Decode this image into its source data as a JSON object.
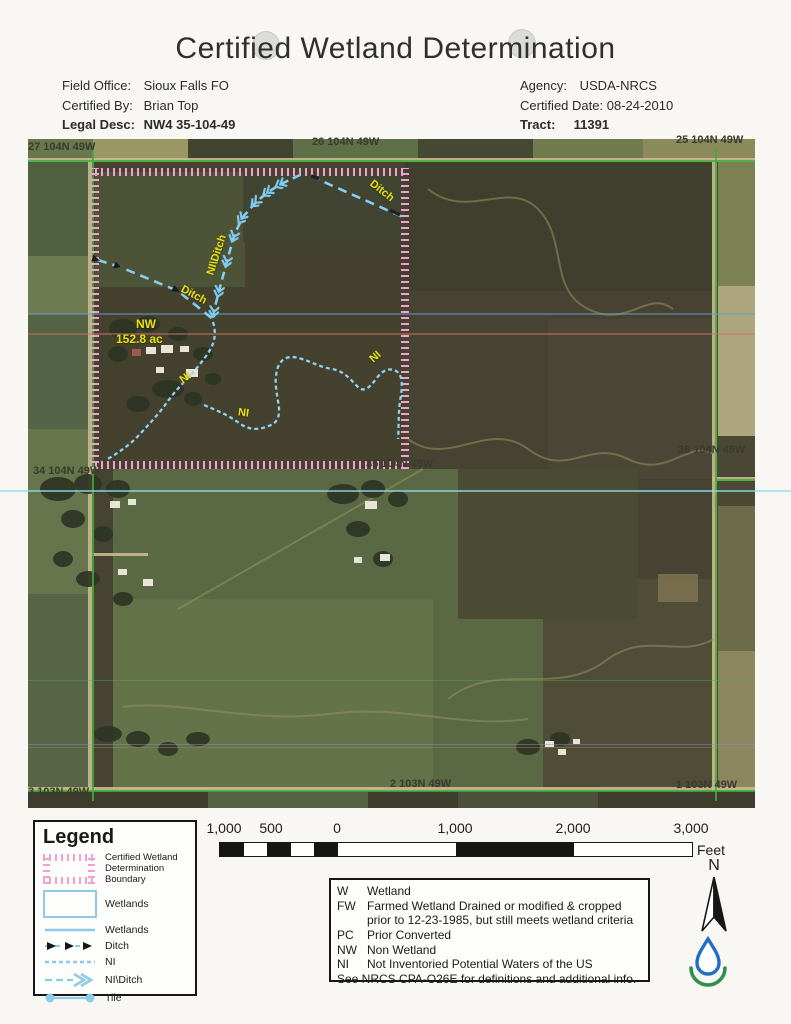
{
  "title": "Certified Wetland Determination",
  "header": {
    "field_office_label": "Field Office:",
    "field_office": "Sioux Falls FO",
    "certified_by_label": "Certified By:",
    "certified_by": "Brian Top",
    "legal_desc_label": "Legal Desc:",
    "legal_desc": "NW4 35-104-49",
    "agency_label": "Agency:",
    "agency": "USDA-NRCS",
    "certified_date_label": "Certified Date:",
    "certified_date": "08-24-2010",
    "tract_label": "Tract:",
    "tract": "11391"
  },
  "map": {
    "sections": [
      {
        "text": "27 104N 49W"
      },
      {
        "text": "26 104N 49W"
      },
      {
        "text": "25 104N 49W"
      },
      {
        "text": "34 104N 49W"
      },
      {
        "text": "35 104N 49W"
      },
      {
        "text": "36 104N 49W"
      },
      {
        "text": "3 103N 49W"
      },
      {
        "text": "2 103N 49W"
      },
      {
        "text": "1 103N 49W"
      }
    ],
    "labels": {
      "ditch_top": "Ditch",
      "ditch_west": "Ditch",
      "ni_ditch": "NI\\Ditch",
      "ni_west": "NI",
      "ni_mid": "NI",
      "ni_east": "NI",
      "area_code": "NW",
      "area_acres": "152.8 ac"
    },
    "colors": {
      "boundary_pink": "#f2a0d0",
      "hydro_blue": "#8ad0f4",
      "label_yellow": "#e6e112",
      "section_green": "#3fae3c"
    }
  },
  "legend": {
    "title": "Legend",
    "items": [
      {
        "label": "Certified Wetland Determination Boundary"
      },
      {
        "label": "Wetlands"
      },
      {
        "label": "Wetlands"
      },
      {
        "label": "Ditch"
      },
      {
        "label": "NI"
      },
      {
        "label": "NI\\Ditch"
      },
      {
        "label": "Tile"
      }
    ]
  },
  "scalebar": {
    "ticks": [
      "1,000",
      "500",
      "0",
      "1,000",
      "2,000",
      "3,000"
    ],
    "unit": "Feet"
  },
  "north": {
    "label": "N"
  },
  "definitions": {
    "rows": [
      {
        "code": "W",
        "text": "Wetland"
      },
      {
        "code": "FW",
        "text": "Farmed Wetland Drained or modified & cropped prior to 12-23-1985, but still meets wetland criteria"
      },
      {
        "code": "PC",
        "text": "Prior Converted"
      },
      {
        "code": "NW",
        "text": "Non Wetland"
      },
      {
        "code": "NI",
        "text": "Not Inventoried Potential Waters of the US"
      }
    ],
    "footnote": "See NRCS CPA-O26E for definitions and additional info."
  }
}
